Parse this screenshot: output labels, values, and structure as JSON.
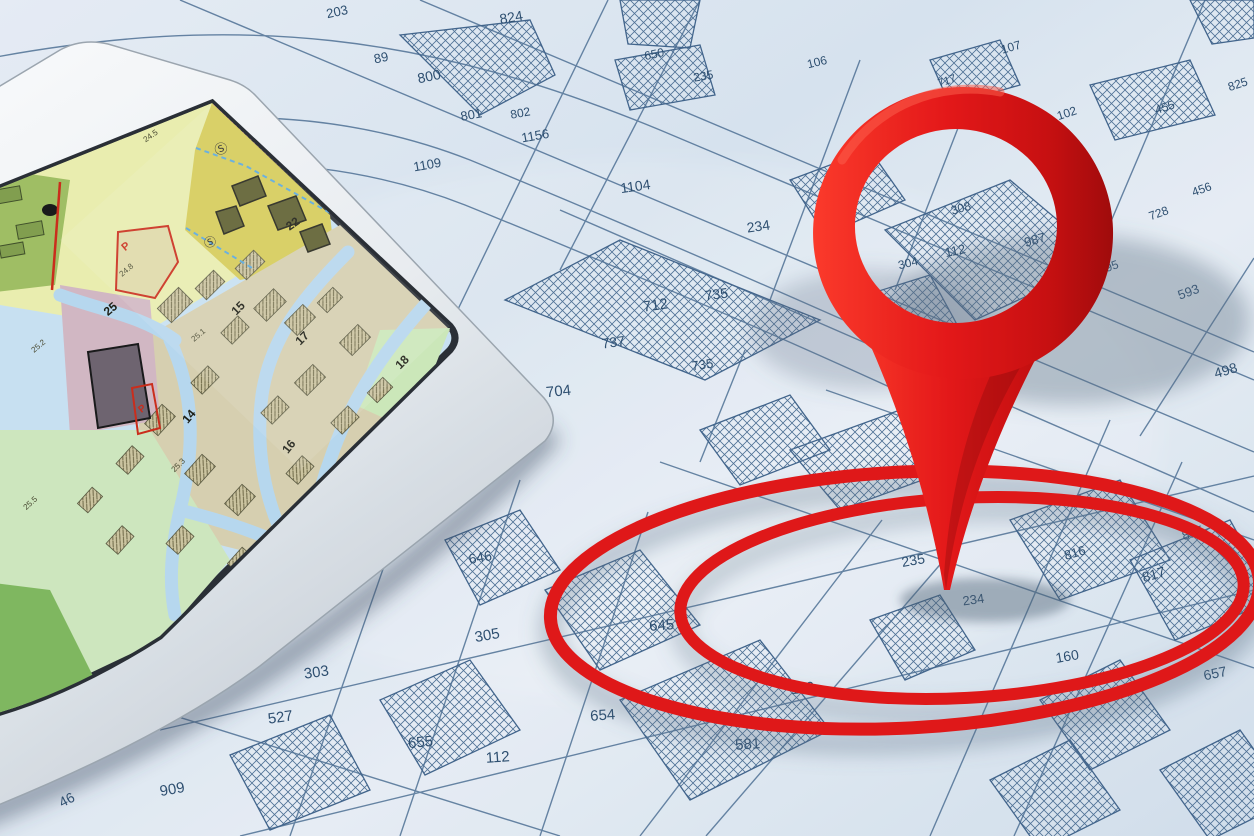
{
  "scene": {
    "caption": "Cadastral parcel map with tablet showing zoning city map and red location pin over circled target parcels"
  },
  "colors": {
    "paper": "#dde7f1",
    "map_line": "#4a6d92",
    "parcel_label": "#27496b",
    "pin_red": "#e20f0f",
    "pin_red_dark": "#9f0202",
    "ring_red": "#e20f0f",
    "tablet_bezel": "#eef1f4",
    "screen_border": "#23282e",
    "screen_water_blue": "#b7d9f0",
    "zone_yellow_green": "#ecf0ad",
    "zone_olive_green": "#9fbe5e",
    "zone_yellow": "#d9cc52",
    "zone_beige": "#d9d0ae",
    "zone_pink": "#d3b7c2",
    "zone_light_green": "#cfe8bd",
    "zone_dark_green": "#7db75a",
    "red_boundary": "#cc2512"
  },
  "paper_map": {
    "labels": [
      {
        "t": "203",
        "x": 338,
        "y": 16,
        "r": -12,
        "s": 13
      },
      {
        "t": "824",
        "x": 512,
        "y": 22,
        "r": -10,
        "s": 14
      },
      {
        "t": "89",
        "x": 382,
        "y": 62,
        "r": -12,
        "s": 13
      },
      {
        "t": "800",
        "x": 430,
        "y": 81,
        "r": -12,
        "s": 14
      },
      {
        "t": "801",
        "x": 472,
        "y": 119,
        "r": -10,
        "s": 13
      },
      {
        "t": "802",
        "x": 521,
        "y": 117,
        "r": -10,
        "s": 12
      },
      {
        "t": "1156",
        "x": 536,
        "y": 140,
        "r": -10,
        "s": 13
      },
      {
        "t": "1109",
        "x": 428,
        "y": 169,
        "r": -10,
        "s": 13
      },
      {
        "t": "1104",
        "x": 636,
        "y": 191,
        "r": -8,
        "s": 14
      },
      {
        "t": "234",
        "x": 759,
        "y": 231,
        "r": -8,
        "s": 14
      },
      {
        "t": "650",
        "x": 655,
        "y": 58,
        "r": -12,
        "s": 12
      },
      {
        "t": "235",
        "x": 704,
        "y": 80,
        "r": -10,
        "s": 12
      },
      {
        "t": "106",
        "x": 818,
        "y": 66,
        "r": -14,
        "s": 12
      },
      {
        "t": "107",
        "x": 1012,
        "y": 51,
        "r": -16,
        "s": 12
      },
      {
        "t": "102",
        "x": 1068,
        "y": 117,
        "r": -18,
        "s": 12
      },
      {
        "t": "455",
        "x": 1166,
        "y": 111,
        "r": -18,
        "s": 12
      },
      {
        "t": "825",
        "x": 1239,
        "y": 88,
        "r": -18,
        "s": 12
      },
      {
        "t": "456",
        "x": 1203,
        "y": 193,
        "r": -20,
        "s": 12
      },
      {
        "t": "728",
        "x": 1160,
        "y": 217,
        "r": -20,
        "s": 12
      },
      {
        "t": "721",
        "x": 1094,
        "y": 196,
        "r": -20,
        "s": 11
      },
      {
        "t": "717",
        "x": 948,
        "y": 84,
        "r": -18,
        "s": 11
      },
      {
        "t": "595",
        "x": 1110,
        "y": 271,
        "r": -20,
        "s": 12
      },
      {
        "t": "593",
        "x": 1190,
        "y": 296,
        "r": -20,
        "s": 13
      },
      {
        "t": "498",
        "x": 1227,
        "y": 375,
        "r": -16,
        "s": 14
      },
      {
        "t": "712",
        "x": 656,
        "y": 310,
        "r": -8,
        "s": 15
      },
      {
        "t": "735",
        "x": 717,
        "y": 299,
        "r": -8,
        "s": 14
      },
      {
        "t": "737",
        "x": 614,
        "y": 347,
        "r": -8,
        "s": 14
      },
      {
        "t": "735",
        "x": 703,
        "y": 369,
        "r": -8,
        "s": 13
      },
      {
        "t": "704",
        "x": 559,
        "y": 396,
        "r": -6,
        "s": 15
      },
      {
        "t": "646",
        "x": 481,
        "y": 562,
        "r": -10,
        "s": 14
      },
      {
        "t": "305",
        "x": 488,
        "y": 640,
        "r": -10,
        "s": 15
      },
      {
        "t": "303",
        "x": 317,
        "y": 677,
        "r": -8,
        "s": 15
      },
      {
        "t": "527",
        "x": 281,
        "y": 722,
        "r": -8,
        "s": 15
      },
      {
        "t": "655",
        "x": 421,
        "y": 747,
        "r": -6,
        "s": 15
      },
      {
        "t": "112",
        "x": 498,
        "y": 762,
        "r": -4,
        "s": 15
      },
      {
        "t": "654",
        "x": 603,
        "y": 720,
        "r": -4,
        "s": 15
      },
      {
        "t": "909",
        "x": 173,
        "y": 794,
        "r": -10,
        "s": 15
      },
      {
        "t": "46",
        "x": 69,
        "y": 804,
        "r": -28,
        "s": 14
      },
      {
        "t": "645",
        "x": 662,
        "y": 630,
        "r": -4,
        "s": 15
      },
      {
        "t": "110",
        "x": 803,
        "y": 693,
        "r": -6,
        "s": 15
      },
      {
        "t": "581",
        "x": 748,
        "y": 749,
        "r": -4,
        "s": 15
      },
      {
        "t": "308",
        "x": 962,
        "y": 212,
        "r": -16,
        "s": 12
      },
      {
        "t": "987",
        "x": 1036,
        "y": 244,
        "r": -16,
        "s": 13
      },
      {
        "t": "112",
        "x": 956,
        "y": 255,
        "r": -12,
        "s": 13
      },
      {
        "t": "304",
        "x": 909,
        "y": 267,
        "r": -14,
        "s": 12
      },
      {
        "t": "948",
        "x": 871,
        "y": 322,
        "r": -12,
        "s": 13
      },
      {
        "t": "233",
        "x": 841,
        "y": 516,
        "r": -14,
        "s": 13
      },
      {
        "t": "235",
        "x": 914,
        "y": 565,
        "r": -10,
        "s": 14
      },
      {
        "t": "234",
        "x": 974,
        "y": 604,
        "r": -8,
        "s": 13
      },
      {
        "t": "816",
        "x": 1076,
        "y": 557,
        "r": -16,
        "s": 13
      },
      {
        "t": "817",
        "x": 1155,
        "y": 579,
        "r": -16,
        "s": 14
      },
      {
        "t": "815",
        "x": 1194,
        "y": 537,
        "r": -18,
        "s": 13
      },
      {
        "t": "160",
        "x": 1068,
        "y": 661,
        "r": -10,
        "s": 14
      },
      {
        "t": "657",
        "x": 1216,
        "y": 678,
        "r": -12,
        "s": 14
      }
    ]
  },
  "tablet": {
    "labels": [
      {
        "t": "22",
        "x": 295,
        "y": 227,
        "r": -35,
        "s": 12,
        "c": "#15150a",
        "b": true
      },
      {
        "t": "15",
        "x": 241,
        "y": 311,
        "r": -45,
        "s": 12,
        "c": "#15150a",
        "b": true
      },
      {
        "t": "17",
        "x": 305,
        "y": 341,
        "r": -45,
        "s": 12,
        "c": "#15150a",
        "b": true
      },
      {
        "t": "18",
        "x": 405,
        "y": 365,
        "r": -45,
        "s": 12,
        "c": "#15150a",
        "b": true
      },
      {
        "t": "14",
        "x": 192,
        "y": 419,
        "r": -50,
        "s": 12,
        "c": "#15150a",
        "b": true
      },
      {
        "t": "16",
        "x": 292,
        "y": 449,
        "r": -52,
        "s": 12,
        "c": "#15150a",
        "b": true
      },
      {
        "t": "25",
        "x": 113,
        "y": 312,
        "r": -40,
        "s": 12,
        "c": "#15150a",
        "b": true
      },
      {
        "t": "P",
        "x": 128,
        "y": 249,
        "r": -40,
        "s": 11,
        "c": "#cc2512",
        "b": true
      },
      {
        "t": "P",
        "x": 144,
        "y": 411,
        "r": -40,
        "s": 10,
        "c": "#cc2512",
        "b": true
      },
      {
        "t": "Ⓢ",
        "x": 223,
        "y": 153,
        "r": -25,
        "s": 13,
        "c": "#222222",
        "b": false
      },
      {
        "t": "Ⓢ",
        "x": 212,
        "y": 246,
        "r": -25,
        "s": 12,
        "c": "#222222",
        "b": false
      },
      {
        "t": "24.5",
        "x": 152,
        "y": 138,
        "r": -35,
        "s": 8,
        "c": "#44442a",
        "b": false
      },
      {
        "t": "24.8",
        "x": 128,
        "y": 272,
        "r": -40,
        "s": 8,
        "c": "#44442a",
        "b": false
      },
      {
        "t": "25.1",
        "x": 200,
        "y": 337,
        "r": -40,
        "s": 8,
        "c": "#44442a",
        "b": false
      },
      {
        "t": "25.2",
        "x": 40,
        "y": 348,
        "r": -40,
        "s": 8,
        "c": "#44442a",
        "b": false
      },
      {
        "t": "25.3",
        "x": 180,
        "y": 467,
        "r": -45,
        "s": 8,
        "c": "#44442a",
        "b": false
      },
      {
        "t": "25.5",
        "x": 32,
        "y": 505,
        "r": -42,
        "s": 8,
        "c": "#44442a",
        "b": false
      },
      {
        "t": "24.1",
        "x": 320,
        "y": 500,
        "r": -50,
        "s": 8,
        "c": "#44442a",
        "b": false
      }
    ]
  }
}
